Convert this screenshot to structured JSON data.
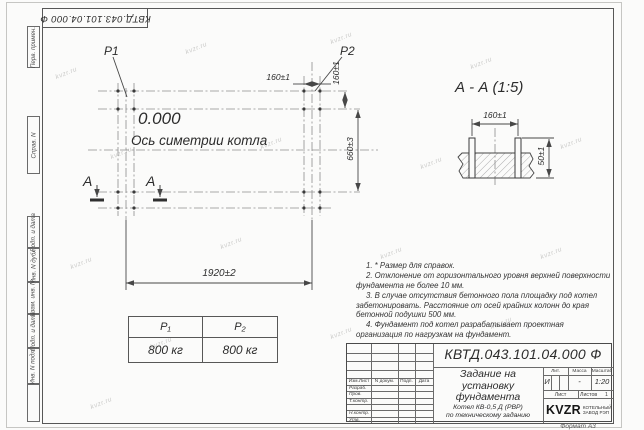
{
  "sheet": {
    "top_stamp": "КВТД.043.101.04.000    Ф",
    "format_label": "Формат А3",
    "watermark": "kvzr.ru"
  },
  "side_labels": {
    "perv": "Перв. примен.",
    "sprav": "Справ. N",
    "podp1": "Подп. и дата",
    "inv_dubl": "Инв. N дубл.",
    "vzam": "Взам. инв. N",
    "podp2": "Подп. и дата",
    "inv_podl": "Инв. N подл."
  },
  "plan": {
    "p1_label": "P1",
    "p2_label": "P2",
    "elevation": "0.000",
    "axis_label": "Ось симетрии котла",
    "dim_160_top": "160±1",
    "dim_160_side": "160±1",
    "dim_660": "660±3",
    "dim_1920": "1920±2",
    "section_letter": "А"
  },
  "section": {
    "title": "А - А (1:5)",
    "dim_160": "160±1",
    "dim_50": "50±1"
  },
  "notes": [
    "1. * Размер для справок.",
    "2. Отклонение от горизонтального уровня верхней поверхности фундамента не более 10 мм.",
    "3. В случае отсутствия бетонного пола площадку под котел забетонировать. Расстояние от осей крайних колонн до края бетонной подушки 500 мм.",
    "4. Фундамент под котел разрабатывает проектная организация по нагрузкам на фундамент."
  ],
  "load_table": {
    "headers": [
      "P₁",
      "P₂"
    ],
    "values": [
      "800 кг",
      "800 кг"
    ]
  },
  "title_block": {
    "designation": "КВТД.043.101.04.000  Ф",
    "title": "Задание на установку фундамента",
    "subtitle_line1": "Котел  КВ-0,5  Д  (РВР)",
    "subtitle_line2": "по техническому заданию",
    "header_cols": [
      "Изм.Лист",
      "N докум.",
      "Подп.",
      "Дата"
    ],
    "rows": [
      "Разраб.",
      "Пров.",
      "Т.контр.",
      "Н.контр.",
      "Утв."
    ],
    "lit_header": "Лит.",
    "lit_value": "И",
    "mass_header": "Масса",
    "mass_value": "-",
    "scale_header": "Масштаб",
    "scale_value": "1:20",
    "sheet_label": "Лист",
    "sheets_label": "Листов",
    "sheets_value": "1",
    "company_logo": "KVZR",
    "company_name_line1": "КОТЕЛЬНЫЙ",
    "company_name_line2": "ЗАВОД РЭП"
  }
}
